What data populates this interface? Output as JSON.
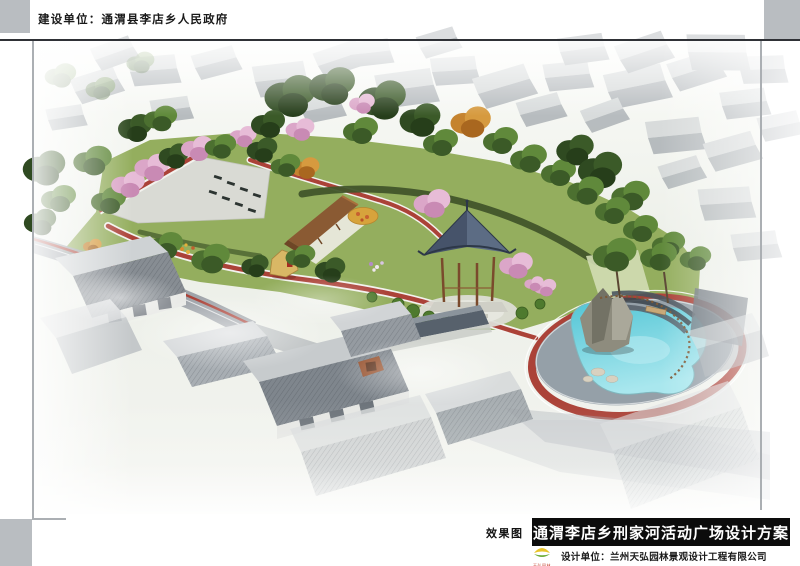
{
  "header": {
    "construction_unit_label": "建设单位：通渭县李店乡人民政府"
  },
  "footer": {
    "figure_type_label": "效果图",
    "title": "通渭李店乡刑家河活动广场设计方案",
    "design_unit_label": "设计单位：兰州天弘园林景观设计工程有限公司",
    "logo_caption": "天弘园林"
  },
  "palette": {
    "frame_gray": "#b9bdc1",
    "title_bar_bg": "#0c0c0c",
    "title_text": "#ffffff",
    "path_red": "#ab4238",
    "water_blue": "#68cfdc",
    "lawn_green": "#94ae5e",
    "tree_dark_green": "#3b5a27",
    "blossom_pink": "#dba6c8",
    "autumn_orange": "#c5832f",
    "roof_gray": "#83888d",
    "pavement_gray": "#d9dad4"
  },
  "scene": {
    "description": "Aerial color rendering of a village activity plaza: paved square with benches, cherry-blossom trees, wooden pergola, flower mound, landmark stone, hexagonal pavilion, kidney-shaped pond with rockery and red jogging track, surrounded by faded gray courtyard houses and village roads",
    "elements": [
      "background-village-houses",
      "tree-belt",
      "paved-plaza",
      "plaza-benches",
      "cherry-blossom-trees",
      "wooden-pergola",
      "flower-mound",
      "landmark-stone",
      "hexagonal-pavilion",
      "clipped-ball-shrubs",
      "kidney-pond",
      "pond-rockery",
      "pond-fence",
      "red-jogging-path",
      "village-road",
      "courtyard-houses"
    ]
  }
}
